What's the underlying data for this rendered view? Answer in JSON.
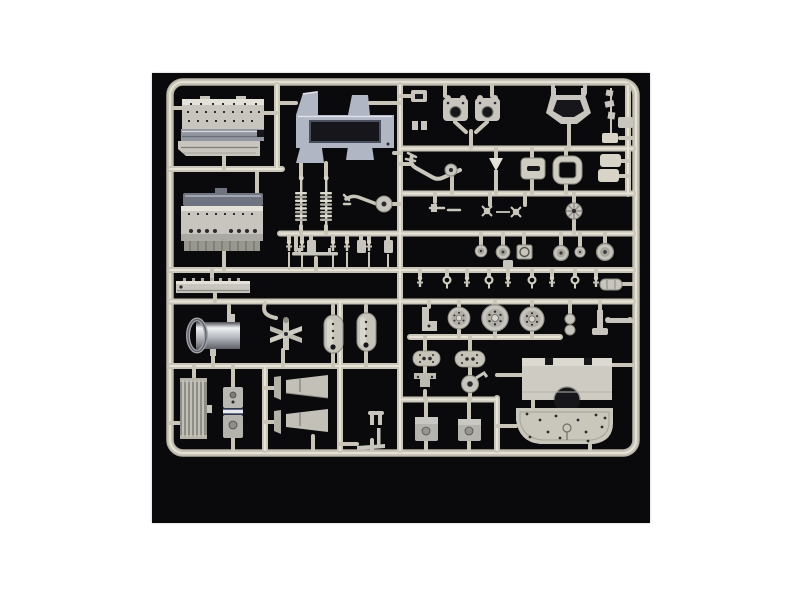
{
  "image": {
    "kind": "photograph",
    "alt": "Unpainted light-gray injection-molded model kit sprue (parts tree) with engine blocks, chassis cradle, springs, cylinder tank, radiator, capsule tanks, pulleys, wheels, fender and tray parts, photographed on a black background centered on a white page"
  },
  "photo_area": {
    "x": 152,
    "y": 73,
    "width": 498,
    "height": 450
  },
  "palette": {
    "page_bg": "#ffffff",
    "photo_bg": "#0a0a0d",
    "runner": "#c9c6b9",
    "runner_light": "#e7e4d7",
    "runner_dark": "#b5b2a5",
    "part_gray": "#c7c5bd",
    "part_light": "#e3e1d8",
    "part_mid": "#b0aea6",
    "part_dark": "#8f8e86",
    "steel_blue": "#b1b6c5",
    "steel_dark": "#6f7480",
    "metal_hi": "#eef0f2",
    "metal_lo": "#5f6168",
    "hole_dark": "#17171b"
  }
}
